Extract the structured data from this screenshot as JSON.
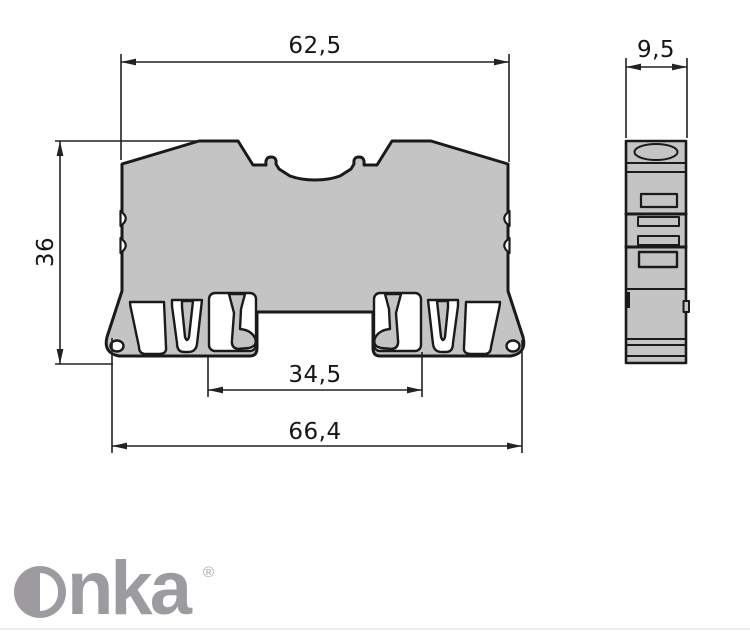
{
  "drawing": {
    "type": "technical dimension drawing",
    "views": [
      "front profile",
      "side profile"
    ],
    "front_view": {
      "top_width": "62,5",
      "height": "36",
      "inner_width": "34,5",
      "bottom_width": "66,4"
    },
    "side_view": {
      "width": "9,5"
    },
    "colors": {
      "body_fill": "#c4c4c4",
      "outline": "#1a1a1a",
      "dimension_lines": "#222222"
    }
  },
  "logo": {
    "brand": "Onka",
    "rest": "nka",
    "registered": "®",
    "color": "#9d9ba0"
  }
}
